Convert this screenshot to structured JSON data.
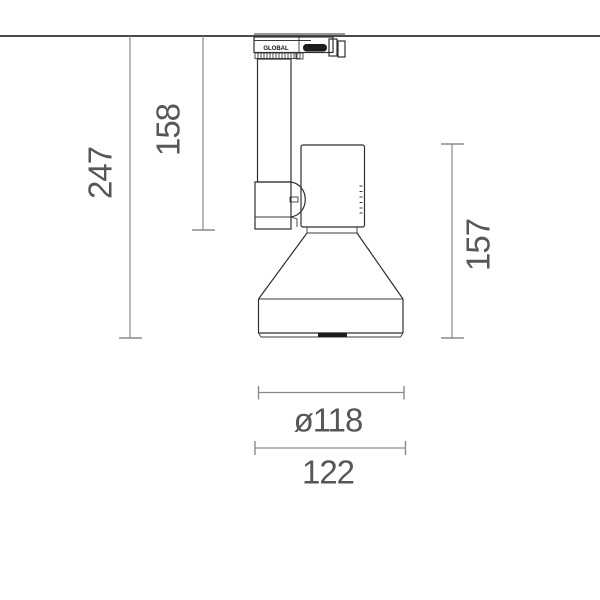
{
  "page": {
    "type": "technical-dimension-drawing",
    "subject": "ceiling track spotlight, side elevation",
    "background_color": "#ffffff"
  },
  "colors": {
    "fixture_outline": "#2e2e2e",
    "dimension_lines": "#8a8a8a",
    "dimension_text": "#575757",
    "lens_fill": "#1c1c1c"
  },
  "dimensions": {
    "overall_height": "247",
    "arm_height": "158",
    "head_height": "157",
    "diffuser_diameter": "ø118",
    "overall_width": "122"
  },
  "adapter": {
    "brand_label": "GLOBAL"
  }
}
